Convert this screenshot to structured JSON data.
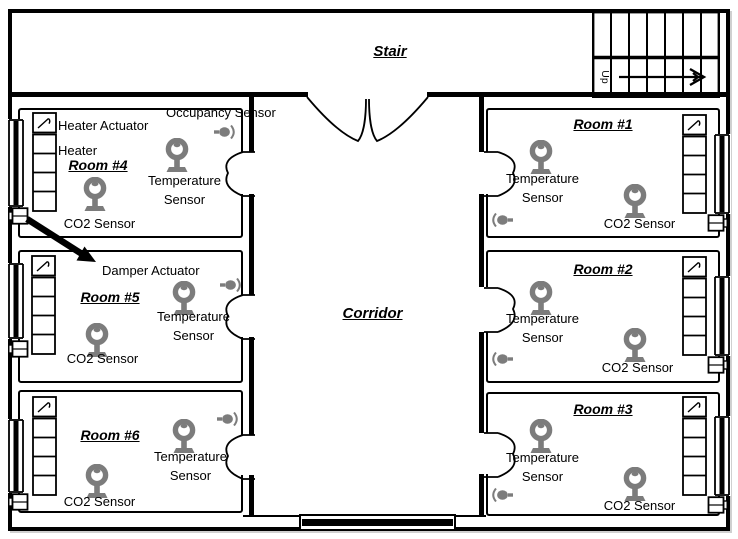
{
  "plan": {
    "stair_label": "Stair",
    "up_label": "Up",
    "corridor_label": "Corridor"
  },
  "labels": {
    "occupancy_sensor": "Occupancy Sensor",
    "heater_actuator": "Heater Actuator",
    "heater": "Heater",
    "damper_actuator": "Damper Actuator",
    "temperature_sensor": "Temperature Sensor",
    "co2_sensor": "CO2 Sensor"
  },
  "rooms": [
    {
      "title": "Room #1"
    },
    {
      "title": "Room #2"
    },
    {
      "title": "Room #3"
    },
    {
      "title": "Room #4"
    },
    {
      "title": "Room #5"
    },
    {
      "title": "Room #6"
    }
  ],
  "colors": {
    "wall": "#000000",
    "icon_gray": "#7c7c7c",
    "background": "#ffffff"
  }
}
